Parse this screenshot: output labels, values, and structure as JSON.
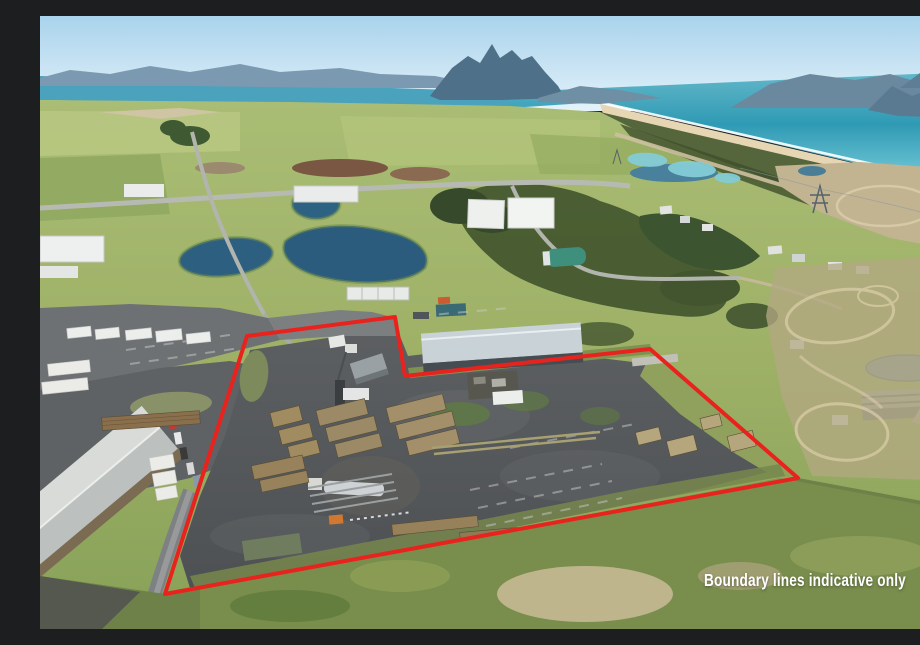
{
  "canvas": {
    "width": 920,
    "height": 613
  },
  "photo": {
    "kind": "aerial-drone-property-photo",
    "caption": "Boundary lines indicative only"
  },
  "boundary": {
    "color": "#e8231e",
    "stroke_width": 4,
    "points": "207,320 355,301 365,360 610,333 758,462 125,578"
  },
  "palette": {
    "sky": "#a9d3ec",
    "ocean": "#2f9ab4",
    "harbor": "#4aa2bd",
    "beach_sand": "#e6d6b4",
    "fields_green": "#9db066",
    "scrub_dark": "#46592f",
    "pond_blue": "#2b5c7d",
    "yard_asphalt": "#54575a",
    "timber_stack": "#a18b60",
    "boundary_red": "#e8231e",
    "caption_text": "#ffffff"
  }
}
